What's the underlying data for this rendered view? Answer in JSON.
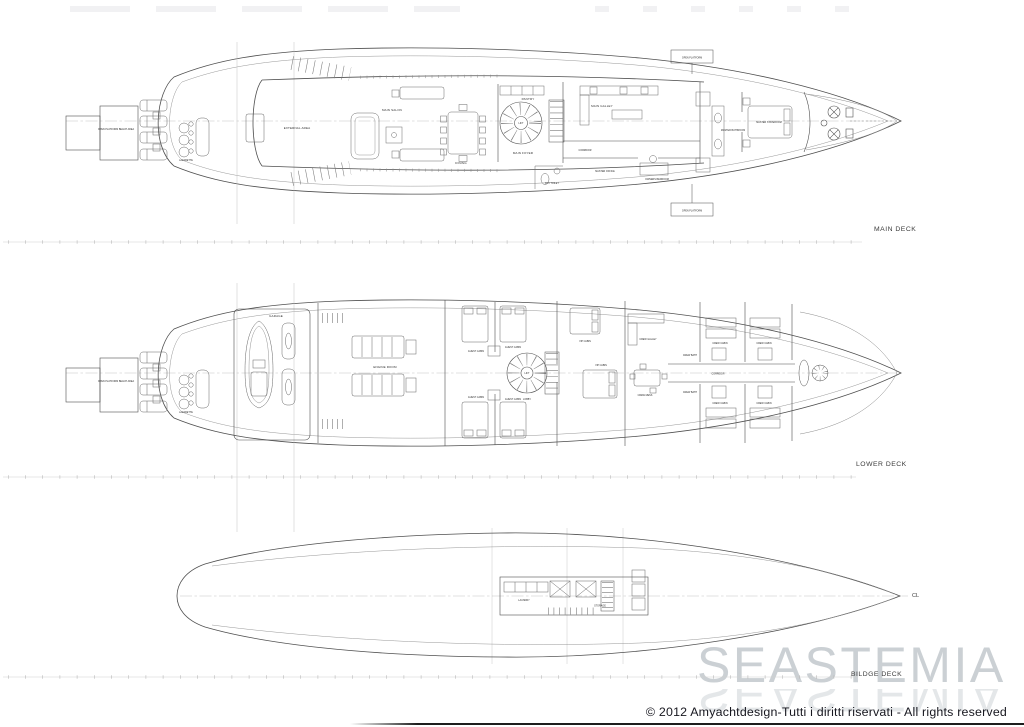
{
  "sheet": {
    "watermark": "SEASTEMIA",
    "copyright": "© 2012 Amyachtdesign-Tutti i diritti riservati - All rights reserved"
  },
  "decks": {
    "main": {
      "title": "MAIN DECK",
      "rooms": {
        "open_platform_beach_area": "OPEN PLATFORM BEACH AREA",
        "lazarette": "LAZARETTE",
        "external_area": "EXTERNAL AREA",
        "main_salon": "MAIN SALON",
        "dining": "DINING",
        "pantry": "PANTRY",
        "main_foyer": "MAIN FOYER",
        "lift": "LIFT",
        "day_toilet": "DAY TOILET",
        "main_galley": "MAIN GALLEY",
        "corridor": "CORRIDOR",
        "master_office": "MASTER OFFICE",
        "owners_bedroom": "OWNERS BEDROOM",
        "master_bathroom": "MASTER BATHROOM",
        "master_stateroom": "MASTER STATEROOM",
        "open_platform": "OPEN PLATFORM"
      }
    },
    "lower": {
      "title": "LOWER DECK",
      "rooms": {
        "open_platform_beach_area": "OPEN PLATFORM BEACH AREA",
        "lazarette": "LAZARETTE",
        "garage": "GARAGE",
        "engine_room": "ENGINE ROOM",
        "guest_cabin": "GUEST CABIN",
        "lobby": "LOBBY",
        "lift": "LIFT",
        "vip_cabin": "VIP CABIN",
        "crew_galley": "CREW GALLEY",
        "crew_mess": "CREW MESS",
        "corridor": "CORRIDOR",
        "crew_cabin": "CREW CABIN",
        "crew_bath": "CREW BATH"
      }
    },
    "bilge": {
      "title": "BILDGE DECK",
      "cl": "CL",
      "rooms": {
        "laundry": "LAUNDRY",
        "storage": "STORAGE"
      }
    }
  }
}
